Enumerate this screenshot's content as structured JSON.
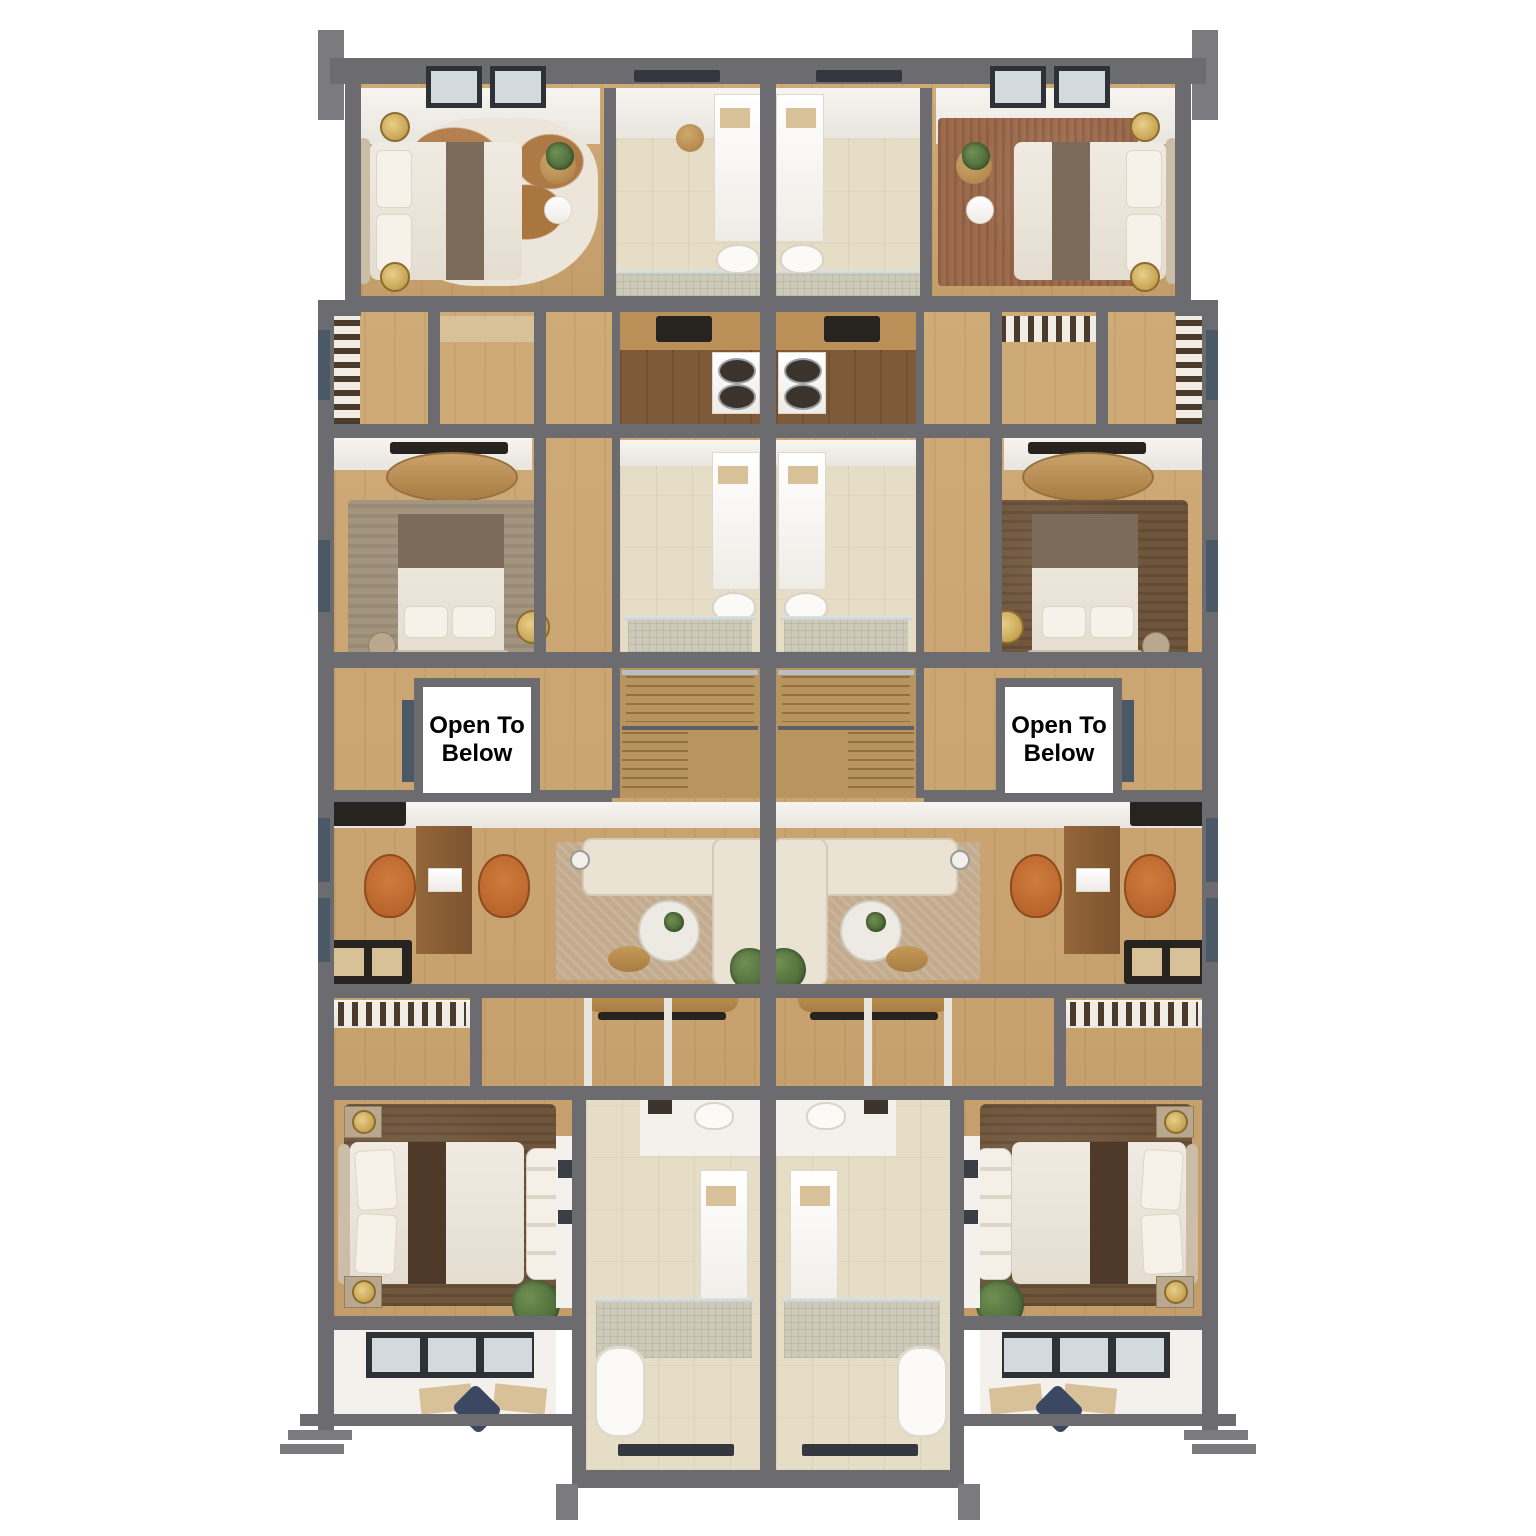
{
  "annotations": {
    "open_to_below_left": "Open To Below",
    "open_to_below_right": "Open To Below"
  },
  "palette": {
    "wall": "#6c6b70",
    "floor_wood": "#c9a470",
    "floor_wood_dark": "#7e5a39",
    "tile": "#e6ddc7",
    "mosaic": "#cdcaba",
    "white_room": "#f4f1ec",
    "rug_brown": "#6f553c",
    "rug_living": "#c3ab8e",
    "rug_gray": "#a3957f",
    "sofa": "#eae2d3",
    "chair_orange": "#b15f28",
    "gold": "#b8913c",
    "plant": "#3f5c2f",
    "slate": "#4b5866",
    "frame_dark": "#2e3236",
    "stair_wood": "#b8945f",
    "desk_wood": "#93663a",
    "console_black": "#27241f",
    "label_bg": "#ffffff",
    "label_text": "#000000"
  }
}
